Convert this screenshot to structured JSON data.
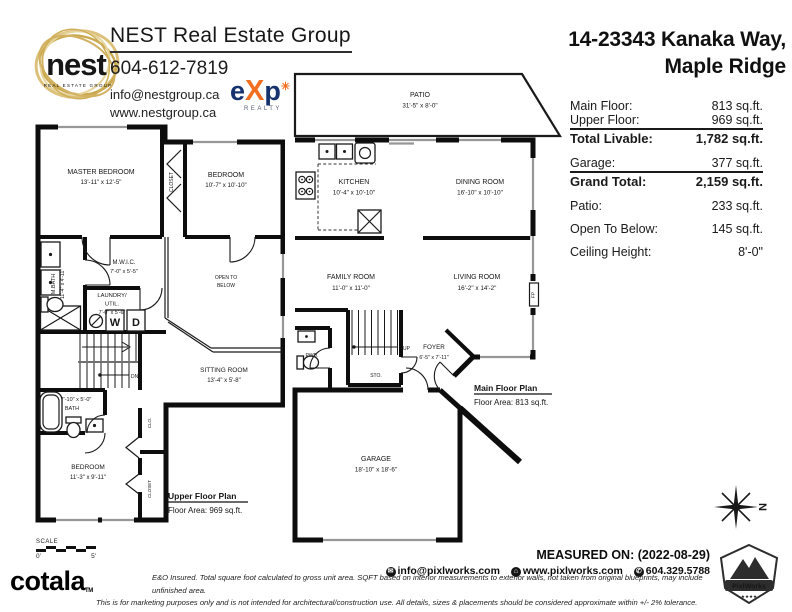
{
  "brand": {
    "logo_word": "nest",
    "logo_tagline": "REAL ESTATE GROUP",
    "name": "NEST Real Estate Group",
    "phone": "604-612-7819",
    "email": "info@nestgroup.ca",
    "website": "www.nestgroup.ca",
    "exp": {
      "e": "e",
      "x": "X",
      "p": "p",
      "plus": "✳",
      "realty": "REALTY"
    }
  },
  "address": {
    "line1": "14-23343 Kanaka Way,",
    "line2": "Maple Ridge"
  },
  "summary": {
    "rows": [
      {
        "label": "Main Floor:",
        "value": "813 sq.ft."
      },
      {
        "label": "Upper Floor:",
        "value": "969 sq.ft."
      },
      {
        "label": "Total Livable:",
        "value": "1,782 sq.ft."
      },
      {
        "label": "Garage:",
        "value": "377 sq.ft."
      },
      {
        "label": "Grand Total:",
        "value": "2,159 sq.ft."
      },
      {
        "label": "Patio:",
        "value": "233 sq.ft."
      },
      {
        "label": "Open To Below:",
        "value": "145 sq.ft."
      },
      {
        "label": "Ceiling Height:",
        "value": "8'-0\""
      }
    ]
  },
  "upper_plan": {
    "title": "Upper Floor Plan",
    "area": "Floor Area: 969 sq.ft.",
    "rooms": {
      "master": {
        "name": "MASTER BEDROOM",
        "dims": "13'-11\" x 12'-5\""
      },
      "bedroom2": {
        "name": "BEDROOM",
        "dims": "10'-7\" x 10'-10\""
      },
      "closet_top": {
        "name": "CLOSET"
      },
      "mwic": {
        "name": "M.W.I.C.",
        "dims": "7'-0\" x 5'-5\""
      },
      "mbath": {
        "name": "M.BATH",
        "dims": "11'-4\" x 4'-11\""
      },
      "laundry": {
        "name": "LAUNDRY/",
        "name2": "UTIL.",
        "dims": "7'-0\" x 5'-6\""
      },
      "open_below": {
        "name": "OPEN TO",
        "name2": "BELOW"
      },
      "sitting": {
        "name": "SITTING ROOM",
        "dims": "13'-4\" x 5'-8\""
      },
      "bath": {
        "dims": "7'-10\" x 5'-0\"",
        "name": "BATH"
      },
      "bedroom3": {
        "name": "BEDROOM",
        "dims": "11'-3\" x 9'-11\""
      },
      "clo": {
        "name": "CLO."
      },
      "closet_lower": {
        "name": "CLOSET"
      },
      "dn": "DN",
      "w": "W",
      "d": "D"
    }
  },
  "main_plan": {
    "title": "Main Floor Plan",
    "area": "Floor Area: 813 sq.ft.",
    "rooms": {
      "patio": {
        "name": "PATIO",
        "dims": "31'-5\" x 8'-0\""
      },
      "kitchen": {
        "name": "KITCHEN",
        "dims": "10'-4\" x 10'-10\""
      },
      "dining": {
        "name": "DINING ROOM",
        "dims": "16'-10\" x 10'-10\""
      },
      "family": {
        "name": "FAMILY ROOM",
        "dims": "11'-0\" x 11'-0\""
      },
      "living": {
        "name": "LIVING ROOM",
        "dims": "16'-2\" x 14'-2\""
      },
      "foyer": {
        "name": "FOYER",
        "dims": "6'-5\" x 7'-11\""
      },
      "garage": {
        "name": "GARAGE",
        "dims": "18'-10\" x 18'-6\""
      },
      "pwd": {
        "name": "PWD."
      },
      "sto": {
        "name": "STO."
      },
      "up": "UP",
      "fp": "FP"
    }
  },
  "compass": {
    "north": "N"
  },
  "scalebar": {
    "label": "SCALE",
    "start": "0'",
    "end": "5'"
  },
  "footer": {
    "cotala": "cotala",
    "tm": "TM",
    "disclaimer1": "E&O Insured.  Total square foot calculated to gross unit area. SQFT based on interior measurements to exterior walls, not taken from original blueprints, may include unfinished area.",
    "disclaimer2": "This is for marketing purposes only and is not intended for architectural/construction use.  All details, sizes & placements should be considered approximate within +/- 2%  tolerance.",
    "measured_on": "MEASURED ON: (2022-08-29)",
    "email": "info@pixlworks.com",
    "website": "www.pixlworks.com",
    "phone": "604.329.5788",
    "email_icon": "✉",
    "web_icon": "⌂",
    "phone_icon": "✆",
    "pixlworks": "PixlWorks",
    "stars": "★★★★"
  },
  "colors": {
    "wall": "#0d0d0d",
    "window": "#979797",
    "nest_gold": "#d5b96f",
    "exp_navy": "#15316e",
    "exp_orange": "#f26f21"
  }
}
